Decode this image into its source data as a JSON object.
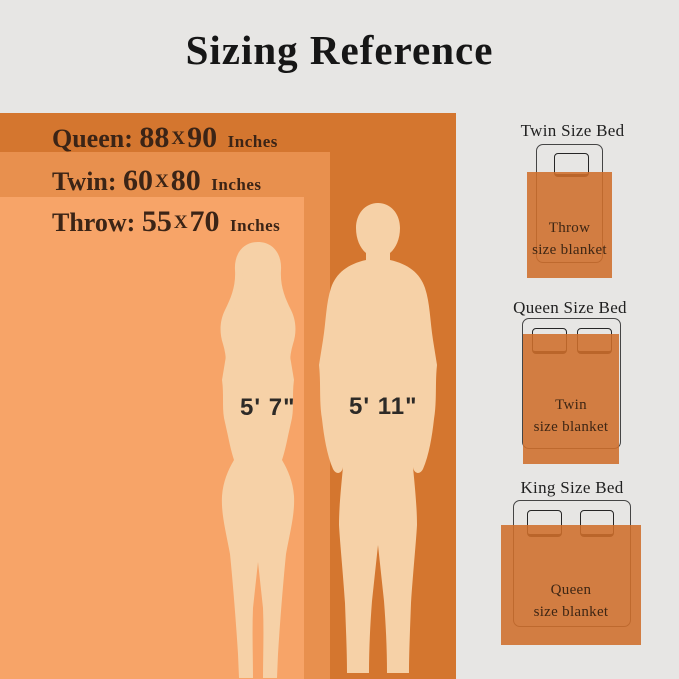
{
  "title": "Sizing Reference",
  "size_rows": [
    {
      "label": "Queen:",
      "width": "88",
      "sep": "X",
      "height": "90",
      "unit": "Inches"
    },
    {
      "label": "Twin:",
      "width": "60",
      "sep": "X",
      "height": "80",
      "unit": "Inches"
    },
    {
      "label": "Throw:",
      "width": "55",
      "sep": "X",
      "height": "70",
      "unit": "Inches"
    }
  ],
  "figures": {
    "woman_height": "5' 7\"",
    "man_height": "5' 11\""
  },
  "beds": [
    {
      "title": "Twin Size Bed",
      "blanket_line1": "Throw",
      "blanket_line2": "size blanket"
    },
    {
      "title": "Queen Size Bed",
      "blanket_line1": "Twin",
      "blanket_line2": "size blanket"
    },
    {
      "title": "King Size Bed",
      "blanket_line1": "Queen",
      "blanket_line2": "size blanket"
    }
  ],
  "colors": {
    "background": "#e7e6e4",
    "queen_rect": "#d4762f",
    "twin_rect": "#e8904e",
    "throw_rect": "#f7a468",
    "blanket": "#cf6e2b",
    "silhouette": "#f6d1a7",
    "text_dark": "#3b2416"
  }
}
